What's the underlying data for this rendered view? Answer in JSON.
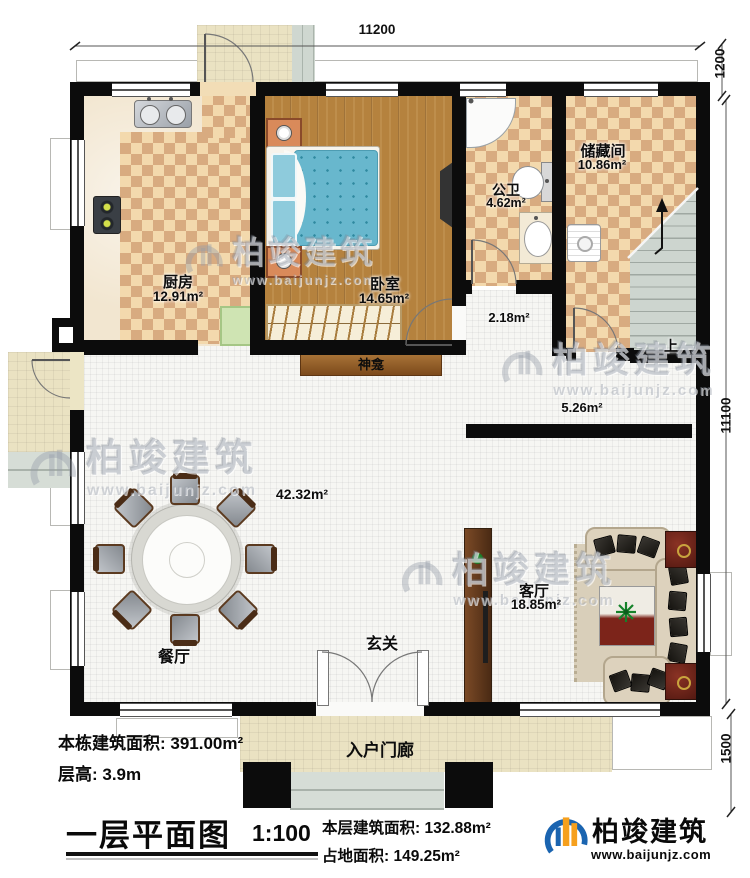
{
  "dimensions": {
    "top_width": "11200",
    "right_upper": "1200",
    "right_height": "11100",
    "right_lower": "1500"
  },
  "rooms": {
    "kitchen": {
      "name": "厨房",
      "area": "12.91m²"
    },
    "bedroom": {
      "name": "卧室",
      "area": "14.65m²"
    },
    "bathroom": {
      "name": "公卫",
      "area": "4.62m²"
    },
    "storage": {
      "name": "储藏间",
      "area": "10.86m²"
    },
    "hall": {
      "area": "2.18m²"
    },
    "corridor": {
      "area": "5.26m²"
    },
    "great_room": {
      "area": "42.32m²"
    },
    "dining": {
      "name": "餐厅"
    },
    "living": {
      "name": "客厅",
      "area": "18.85m²"
    },
    "foyer": {
      "name": "玄关"
    },
    "shrine": {
      "name": "神龛"
    },
    "entry_porch": {
      "name": "入户门廊"
    },
    "stairs": {
      "label": "上"
    }
  },
  "annotations": {
    "building_total": "本栋建筑面积: 391.00m²",
    "floor_height": "层高: 3.9m",
    "floor_area": "本层建筑面积: 132.88m²",
    "footprint": "占地面积: 149.25m²"
  },
  "titleblock": {
    "title": "一层平面图",
    "scale": "1:100"
  },
  "brand": {
    "name": "柏竣建筑",
    "url": "www.baijunjz.com"
  },
  "watermark": {
    "name": "柏竣建筑",
    "url": "www.baijunjz.com"
  }
}
